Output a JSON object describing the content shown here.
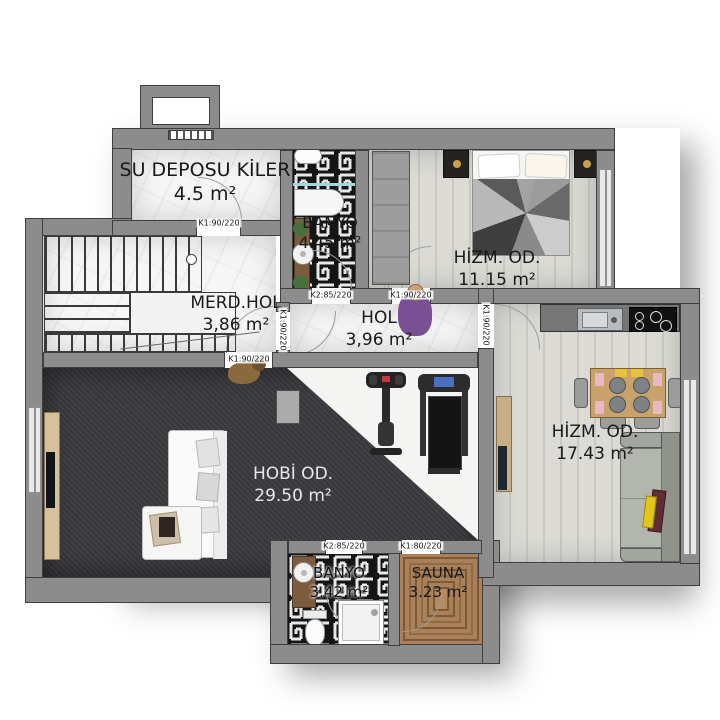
{
  "plan_type": "architectural floor plan (basement floor)",
  "rooms": [
    {
      "name": "SU DEPOSU KİLER",
      "area": "4.5 m²"
    },
    {
      "name": "BANYO",
      "area": "4.45 m²"
    },
    {
      "name": "HİZM. OD.",
      "area": "11.15 m²"
    },
    {
      "name": "MERD.HOL",
      "area": "3,86 m²"
    },
    {
      "name": "HOL",
      "area": "3,96 m²"
    },
    {
      "name": "HİZM. OD.",
      "area": "17.43 m²"
    },
    {
      "name": "HOBİ OD.",
      "area": "29.50 m²"
    },
    {
      "name": "BANYO",
      "area": "3.42 m²"
    },
    {
      "name": "SAUNA",
      "area": "3.23 m²"
    }
  ],
  "door_labels": [
    {
      "text": "K1:90/220"
    },
    {
      "text": "K2:85/220"
    },
    {
      "text": "K1:90/220"
    },
    {
      "text": "K1:90/220"
    },
    {
      "text": "K1:90/220"
    },
    {
      "text": "K1:90/220"
    },
    {
      "text": "K2:85/220"
    },
    {
      "text": "K1:80/220"
    }
  ],
  "furniture": [
    "staircase",
    "bed",
    "wardrobe",
    "nightstand",
    "bathtub",
    "washbasin",
    "toilet",
    "plant",
    "kitchen-counter",
    "sink",
    "cooktop",
    "dining-table",
    "chair",
    "sofa",
    "tv-console",
    "exercise-bike",
    "treadmill",
    "shower-tray",
    "sauna-benches",
    "person-figure",
    "dog-figure"
  ],
  "colors": {
    "wall": "#8c8c8c",
    "wall_outline": "#3f3f3f",
    "marble_floor": "#f6f6f6",
    "wood_floor": "#d8d7d1",
    "carpet": "#3b3b3f",
    "sauna_wood": "#a9805a",
    "tile_dark": "#151515",
    "tile_light": "#e8e8e8",
    "glass_partition": "#9fd8de",
    "pillow_yellow": "#e3c619",
    "pillow_red": "#5d2f35",
    "person": "#7b4f93"
  }
}
